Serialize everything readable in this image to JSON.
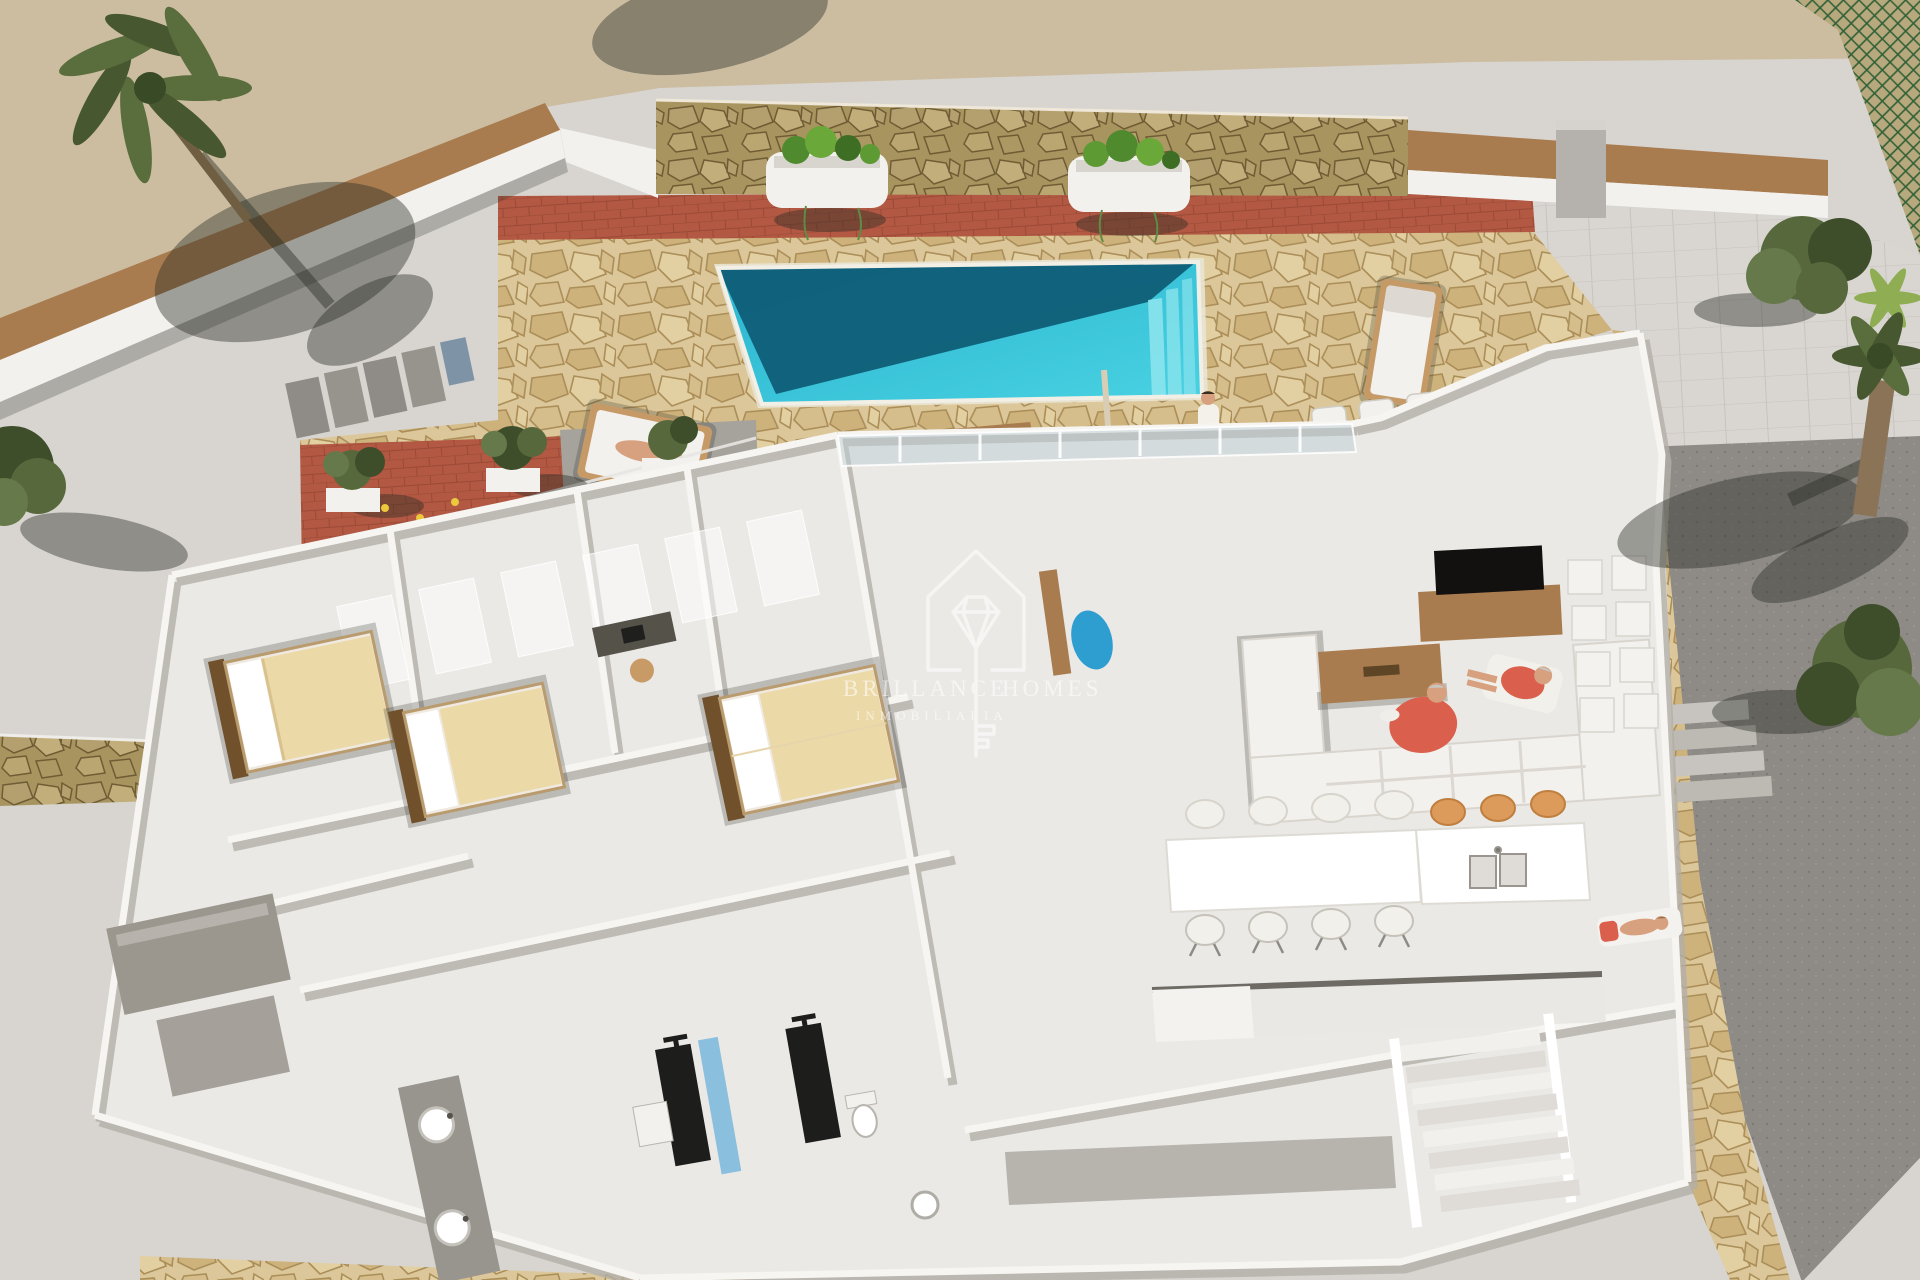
{
  "meta": {
    "kind": "3d-architectural-aerial-render",
    "subject": "single-storey villa cutaway floor plan with pool terrace"
  },
  "watermark": {
    "logo": "house-diamond-key-icon",
    "line1_left": "BRILLANCE",
    "line1_right": "HOMES",
    "line2": "INMOBILIARIA"
  },
  "palette": {
    "ground": "#d8d5d1",
    "sidewalk": "#ccbda1",
    "stone": "#dcc79a",
    "stoneLine": "#ab8e58",
    "stoneWallBase": "#b4a univ06f",
    "terracotta": "#b25843",
    "pool": "#37c4d8",
    "poolDeep": "#0e5a74",
    "poolStep": "#8fe5ee",
    "wall": "#f7f5f2",
    "wallShade": "#b3aea7",
    "floor": "#ebe9e5",
    "wood": "#a97c4f",
    "woodDark": "#71502c",
    "foliage": "#57693c",
    "foliageDark": "#3e4e2b",
    "coral": "#da5f4c",
    "skin": "#d7a07e",
    "stoolTan": "#d9a77e",
    "orange": "#dc9a5b",
    "driveway": "#8e8a85",
    "glass": "#c3d2d8",
    "mosaic": "#3f7fc1",
    "itemBlue": "#2e9ed1",
    "cream": "#ecd9a8"
  },
  "scene": {
    "areas": [
      "street-sidewalk",
      "stone-patio",
      "swimming-pool",
      "terracotta-courtyard",
      "bedroom-wing",
      "bathrooms",
      "living-room",
      "dining-area",
      "kitchen",
      "outdoor-bar",
      "driveway",
      "staircase"
    ],
    "counts": {
      "bedrooms": 3,
      "beds": 3,
      "showers": 2,
      "wall-planters": 2,
      "dining-chairs-white": 8,
      "island-stools-orange": 3,
      "bar-stools": 6,
      "sun-loungers": 2,
      "people": 6,
      "palm-trees": 3,
      "garden-trees": 4
    }
  }
}
